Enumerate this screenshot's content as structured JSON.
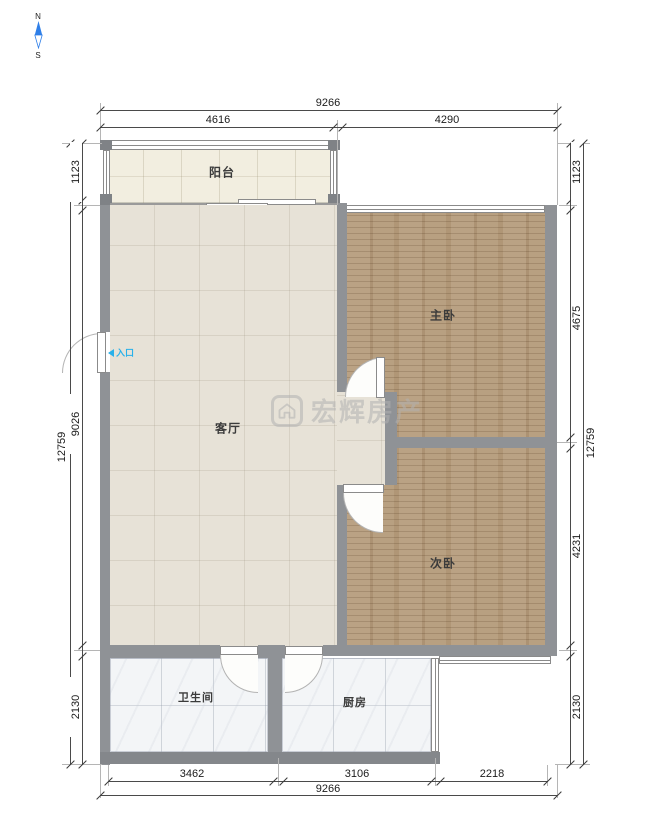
{
  "compass": {
    "north": "N",
    "south": "S"
  },
  "entry": {
    "label": "入口"
  },
  "watermark": {
    "brand": "宏辉房产"
  },
  "rooms": {
    "balcony": {
      "label": "阳台"
    },
    "living": {
      "label": "客厅"
    },
    "master_bedroom": {
      "label": "主卧"
    },
    "second_bedroom": {
      "label": "次卧"
    },
    "bathroom": {
      "label": "卫生间"
    },
    "kitchen": {
      "label": "厨房"
    }
  },
  "dimensions": {
    "top": {
      "total": "9266",
      "segments": [
        "4616",
        "4290"
      ]
    },
    "bottom": {
      "total": "9266",
      "segments": [
        "3462",
        "3106",
        "2218"
      ]
    },
    "left": {
      "total": "12759",
      "segments": [
        "1123",
        "9026",
        "2130"
      ]
    },
    "right": {
      "total": "12759",
      "segments": [
        "1123",
        "4675",
        "4231",
        "2130"
      ]
    }
  },
  "colors": {
    "wood_floor": "#b69d7d",
    "living_floor": "#e7e2d7",
    "balcony_floor": "#f2eee0",
    "tile_floor": "#f3f5f7",
    "wall": "#8f9296",
    "entry_accent": "#29b1ea",
    "compass_north": "#2f7fe8",
    "watermark_gray": "#b2b2b2"
  }
}
